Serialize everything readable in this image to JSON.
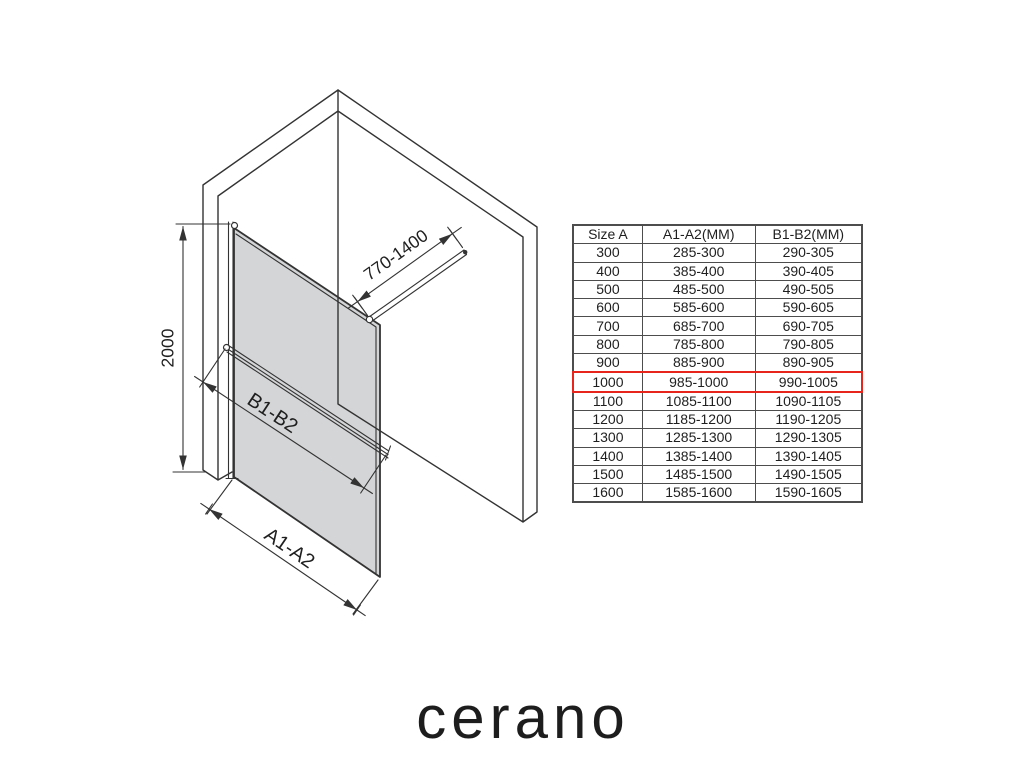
{
  "brand": {
    "logo_text": "cerano"
  },
  "diagram": {
    "dimensions": {
      "height_label": "2000",
      "support_bar_label": "770-1400",
      "glass_width_label": "B1-B2",
      "opening_width_label": "A1-A2"
    }
  },
  "table": {
    "headers": [
      "Size A",
      "A1-A2(MM)",
      "B1-B2(MM)"
    ],
    "highlighted_size": "1000",
    "rows": [
      [
        "300",
        "285-300",
        "290-305"
      ],
      [
        "400",
        "385-400",
        "390-405"
      ],
      [
        "500",
        "485-500",
        "490-505"
      ],
      [
        "600",
        "585-600",
        "590-605"
      ],
      [
        "700",
        "685-700",
        "690-705"
      ],
      [
        "800",
        "785-800",
        "790-805"
      ],
      [
        "900",
        "885-900",
        "890-905"
      ],
      [
        "1000",
        "985-1000",
        "990-1005"
      ],
      [
        "1100",
        "1085-1100",
        "1090-1105"
      ],
      [
        "1200",
        "1185-1200",
        "1190-1205"
      ],
      [
        "1300",
        "1285-1300",
        "1290-1305"
      ],
      [
        "1400",
        "1385-1400",
        "1390-1405"
      ],
      [
        "1500",
        "1485-1500",
        "1490-1505"
      ],
      [
        "1600",
        "1585-1600",
        "1590-1605"
      ]
    ]
  },
  "colors": {
    "highlight-red": "#e8251c",
    "glass-gray": "#d1d2d4",
    "line-dark": "#333333",
    "text-dark": "#1f1f1f",
    "table-border": "#4d4d4d"
  }
}
